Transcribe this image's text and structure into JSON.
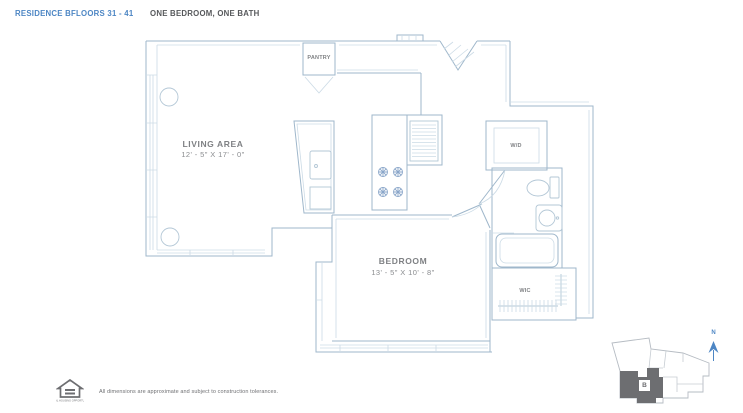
{
  "header": {
    "residence": "RESIDENCE B",
    "floors": "FLOORS 31 - 41",
    "unit_type": "ONE BEDROOM, ONE BATH"
  },
  "plan": {
    "rooms": {
      "living": {
        "label": "LIVING AREA",
        "dimensions": "12' - 5\" X 17' - 0\""
      },
      "bedroom": {
        "label": "BEDROOM",
        "dimensions": "13' - 5\" X 10' - 8\""
      },
      "pantry": {
        "label": "PANTRY"
      },
      "washer_dryer": {
        "label": "W/D"
      },
      "closet": {
        "label": "WIC"
      }
    }
  },
  "key_plan": {
    "unit_letter": "B",
    "compass_label": "N"
  },
  "footer": {
    "disclaimer": "All dimensions are approximate and subject to construction tolerances.",
    "logo_caption": "EQUAL HOUSING OPPORTUNITY",
    "logo_icon": "equal-housing-logo-icon"
  },
  "colors": {
    "header_blue": "#4d86c4",
    "header_dark": "#56585b",
    "plan_wall": "#9fb7cb",
    "plan_light": "#ccdbe6",
    "fixture": "#b3c7d6",
    "burner_blue": "#8aa6c9",
    "label_gray": "#7f8184",
    "keyplan_gray": "#6d6e71",
    "keyplan_outline": "#b6bcc3"
  }
}
